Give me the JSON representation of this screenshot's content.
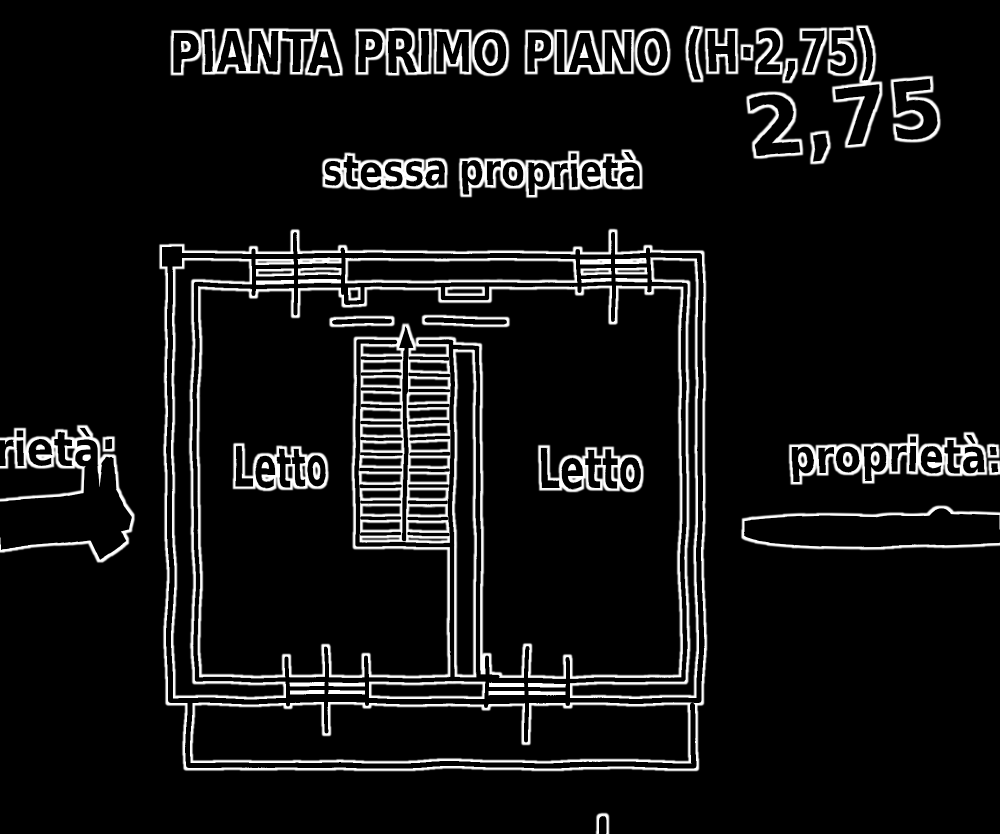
{
  "meta": {
    "background_color": "#000000",
    "ink_color": "#000000",
    "halo_color": "#ffffff",
    "kind": "hand-drawn floor plan sketch"
  },
  "title": {
    "text": "PIANTA PRIMO PIANO (H·2,75)"
  },
  "annotations": {
    "height_note": "2,75"
  },
  "labels": {
    "top_boundary": "stessa proprietà",
    "left_boundary": "rietà:",
    "right_boundary": "proprietà:",
    "room_left": "Letto",
    "room_right": "Letto"
  }
}
